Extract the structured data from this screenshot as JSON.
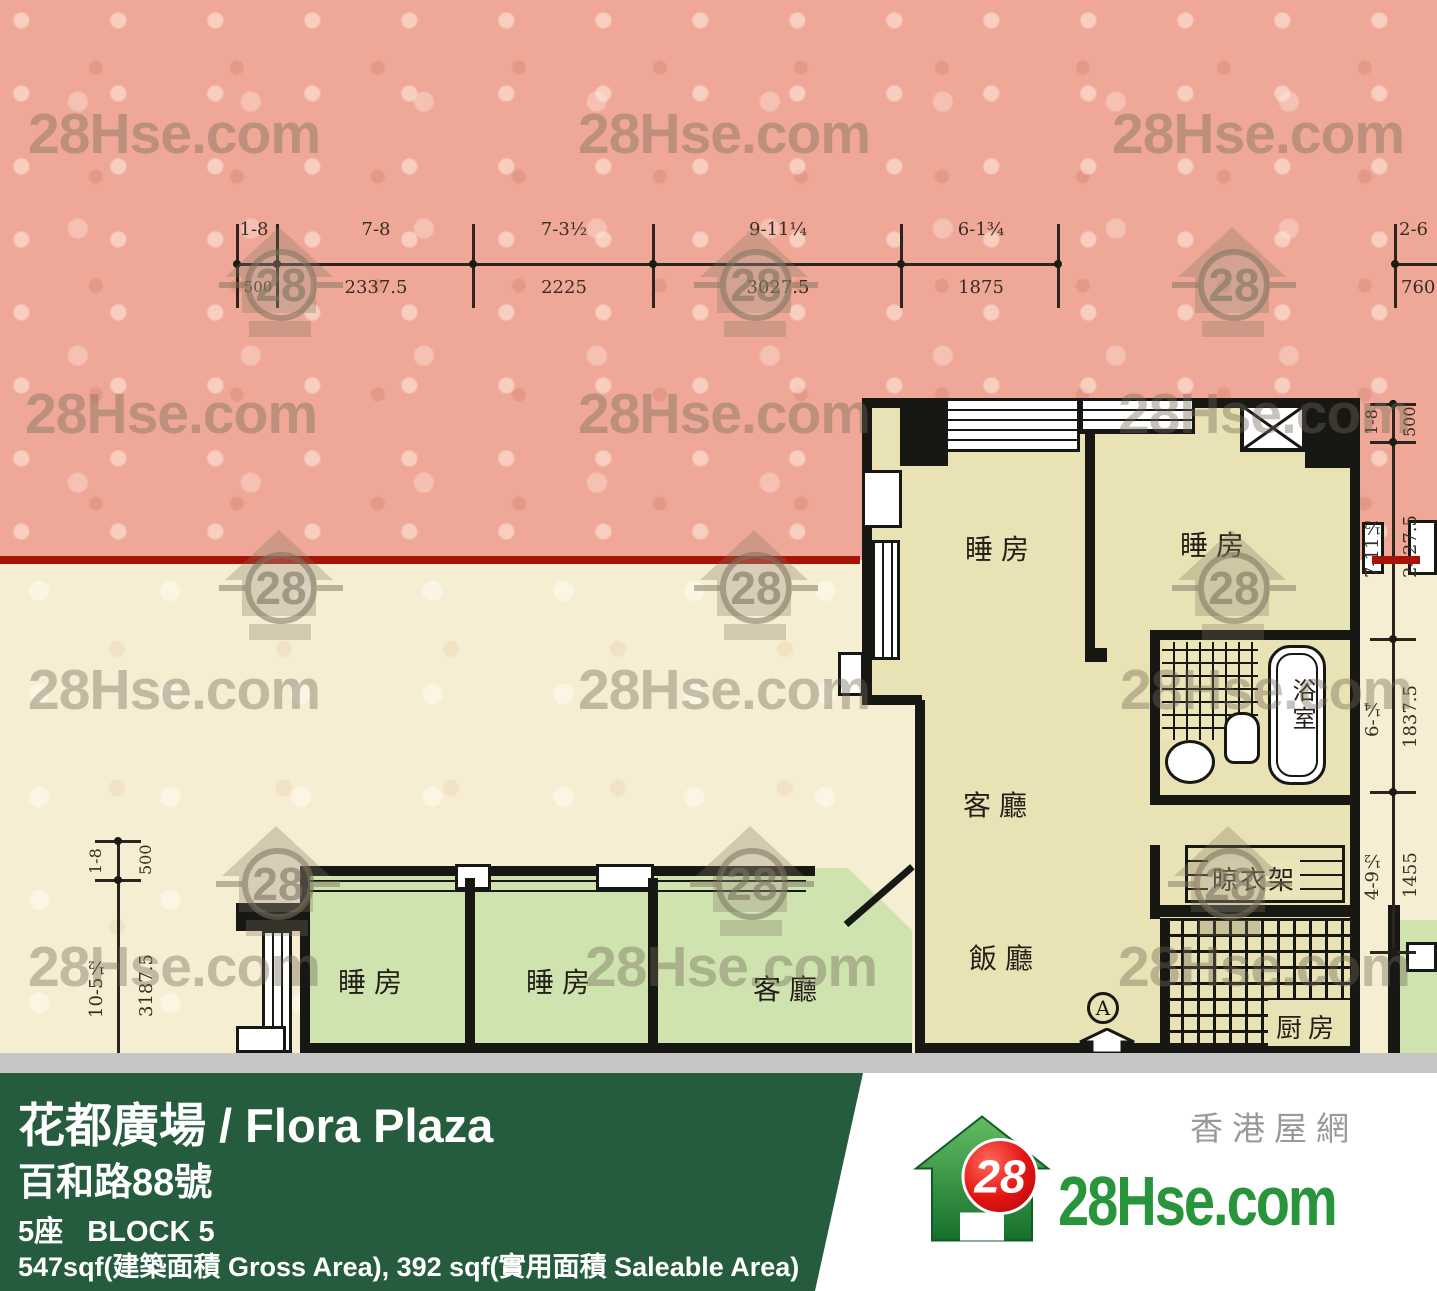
{
  "watermark": {
    "text": "28Hse.com",
    "badge": "28"
  },
  "dims": {
    "top": [
      {
        "ft": "1-8",
        "mm": "500"
      },
      {
        "ft": "7-8",
        "mm": "2337.5"
      },
      {
        "ft": "7-3½",
        "mm": "2225"
      },
      {
        "ft": "9-11¼",
        "mm": "3027.5"
      },
      {
        "ft": "6-1¾",
        "mm": "1875"
      },
      {
        "ft": "2-6",
        "mm": "760"
      }
    ],
    "right": [
      {
        "ft": "1-8",
        "mm": "500"
      },
      {
        "ft": "7-11½",
        "mm": "2427.5"
      },
      {
        "ft": "6-¼",
        "mm": "1837.5"
      },
      {
        "ft": "4-9½",
        "mm": "1455"
      }
    ],
    "left": [
      {
        "ft": "1-8",
        "mm": "500"
      },
      {
        "ft": "10-5½",
        "mm": "3187.5"
      }
    ]
  },
  "plan": {
    "unit_a": {
      "bedroom_1": "睡房",
      "bedroom_2": "睡房",
      "living": "客廳",
      "dining": "飯廳",
      "kitchen": "厨房",
      "bathroom": "浴室",
      "rack": "晾衣架",
      "entrance_label": "A"
    },
    "unit_b": {
      "bedroom_1": "睡房",
      "bedroom_2": "睡房",
      "living": "客廳"
    }
  },
  "banner": {
    "title": "花都廣場 / Flora Plaza",
    "address": "百和路88號",
    "block": "5座   BLOCK 5",
    "area": "547sqf(建築面積 Gross Area), 392 sqf(實用面積 Saleable Area)"
  },
  "logo": {
    "brand": "28Hse.com",
    "brand_cn": "香港屋網",
    "badge": "28"
  },
  "colors": {
    "background_pink": "#efa897",
    "background_cream": "#f6eed2",
    "unit_a_fill": "#e9e2b4",
    "unit_b_fill": "#cfe3ae",
    "red_boundary": "#a81308",
    "banner_green": "#265c3e",
    "logo_green": "#28943c",
    "logo_red": "#dd1414"
  }
}
